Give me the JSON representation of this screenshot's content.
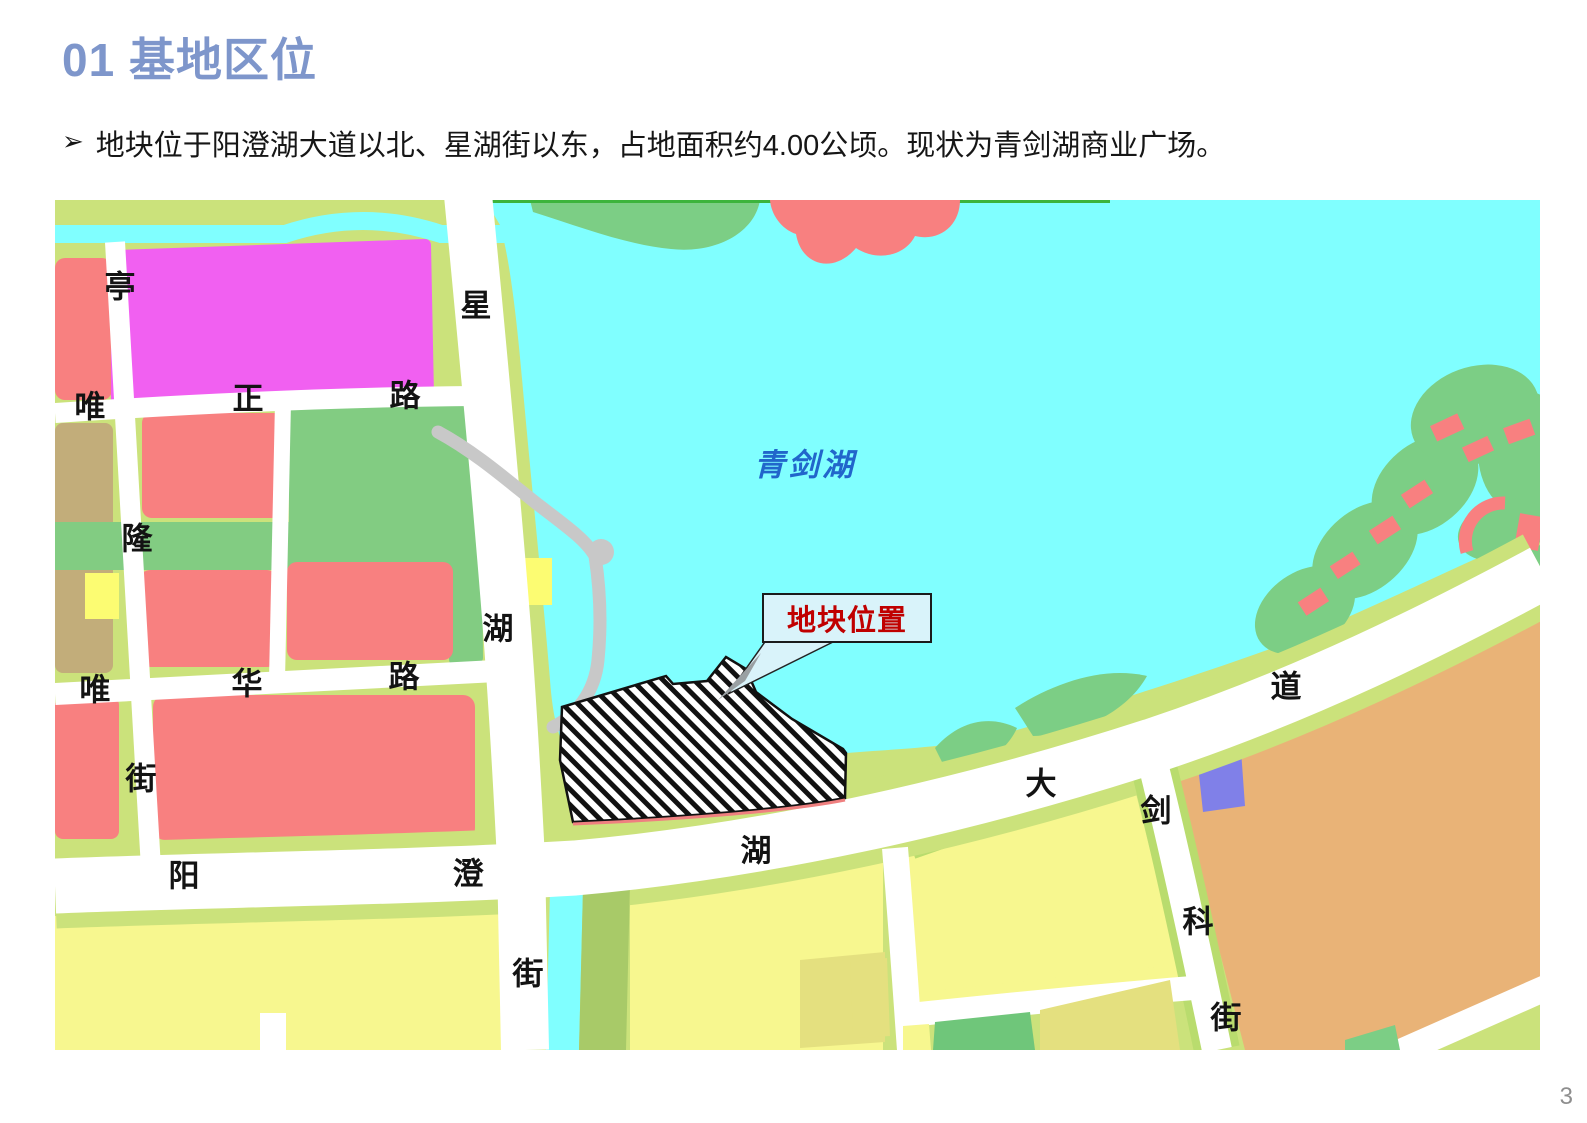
{
  "header": {
    "title": "01 基地区位",
    "bullet_marker": "➢",
    "bullet_text": "地块位于阳澄湖大道以北、星湖街以东，占地面积约4.00公顷。现状为青剑湖商业广场。"
  },
  "footer": {
    "page_number": "3"
  },
  "map": {
    "lake_label": {
      "text": "青剑湖",
      "x": 805,
      "y": 462
    },
    "callout": {
      "text": "地块位置"
    },
    "road_labels": [
      {
        "text": "亭",
        "x": 120,
        "y": 287
      },
      {
        "text": "唯",
        "x": 90,
        "y": 407
      },
      {
        "text": "正",
        "x": 248,
        "y": 399
      },
      {
        "text": "路",
        "x": 405,
        "y": 396
      },
      {
        "text": "星",
        "x": 476,
        "y": 306
      },
      {
        "text": "隆",
        "x": 137,
        "y": 539
      },
      {
        "text": "湖",
        "x": 498,
        "y": 629
      },
      {
        "text": "唯",
        "x": 95,
        "y": 690
      },
      {
        "text": "华",
        "x": 247,
        "y": 684
      },
      {
        "text": "路",
        "x": 404,
        "y": 677
      },
      {
        "text": "街",
        "x": 141,
        "y": 779
      },
      {
        "text": "阳",
        "x": 184,
        "y": 876
      },
      {
        "text": "澄",
        "x": 468,
        "y": 874
      },
      {
        "text": "街",
        "x": 528,
        "y": 974
      },
      {
        "text": "湖",
        "x": 756,
        "y": 851
      },
      {
        "text": "大",
        "x": 1041,
        "y": 784
      },
      {
        "text": "剑",
        "x": 1156,
        "y": 811
      },
      {
        "text": "道",
        "x": 1286,
        "y": 687
      },
      {
        "text": "科",
        "x": 1198,
        "y": 922
      },
      {
        "text": "街",
        "x": 1226,
        "y": 1018
      }
    ],
    "colors": {
      "title": "#7E96CB",
      "lake_fill": "#80FFFF",
      "lake_text": "#2166CB",
      "callout_text": "#C00000",
      "callout_fill": "#D9F3FA",
      "background_land": "#CBE27B",
      "residential_red": "#F88080",
      "commercial_magenta": "#F160F1",
      "park_green": "#7CCE85",
      "block_green": "#82CC82",
      "block_yellow": "#F7F78F",
      "bright_yellow": "#FCFC72",
      "khaki_yellow": "#E4E07F",
      "tan_block": "#C2AD7A",
      "industrial_orange": "#E9B377",
      "utility_blue": "#8080E8",
      "road_white": "#FFFFFF",
      "path_gray": "#C8C8C8"
    }
  }
}
